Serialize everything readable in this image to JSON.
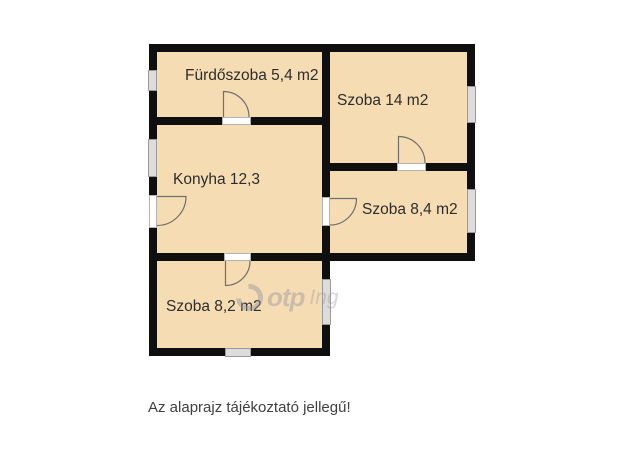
{
  "floorplan": {
    "rooms": [
      {
        "id": "bathroom",
        "label": "Fürdőszoba 5,4 m2"
      },
      {
        "id": "room-14",
        "label": "Szoba 14 m2"
      },
      {
        "id": "kitchen",
        "label": "Konyha 12,3"
      },
      {
        "id": "room-8-4",
        "label": "Szoba 8,4 m2"
      },
      {
        "id": "room-8-2",
        "label": "Szoba 8,2 m2"
      }
    ],
    "watermark": {
      "logo_icon": "otp-swirl-icon",
      "brand": "otp",
      "suffix": "Ing"
    },
    "disclaimer": "Az alaprajz tájékoztató jellegű!",
    "colors": {
      "room_fill": "#f6dcb3",
      "wall": "#0f0f0f",
      "window_fill": "#dcdcdc",
      "window_border": "#9a9a9a",
      "door_arc": "#6f6f6f",
      "label_text": "#2d2d2d",
      "disclaimer_text": "#3f3f3f"
    }
  }
}
